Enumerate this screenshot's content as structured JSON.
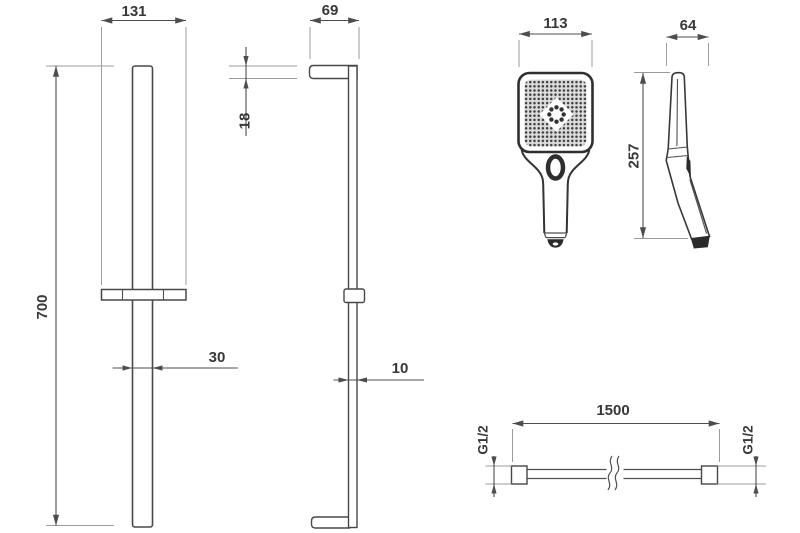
{
  "colors": {
    "background": "#ffffff",
    "dimension_line": "#4d4d4d",
    "extension_line": "#9b9b9b",
    "label_text": "#383838",
    "part_outline": "#484848",
    "dark_detail": "#2b2b2b"
  },
  "rail_front": {
    "width": "131",
    "height": "700",
    "profile_width": "30"
  },
  "rail_side": {
    "depth": "69",
    "bracket_height": "18",
    "profile_depth": "10"
  },
  "handshower": {
    "front_width": "113",
    "height": "257",
    "side_depth": "64"
  },
  "hose": {
    "length": "1500",
    "thread_left": "G1/2",
    "thread_right": "G1/2"
  }
}
